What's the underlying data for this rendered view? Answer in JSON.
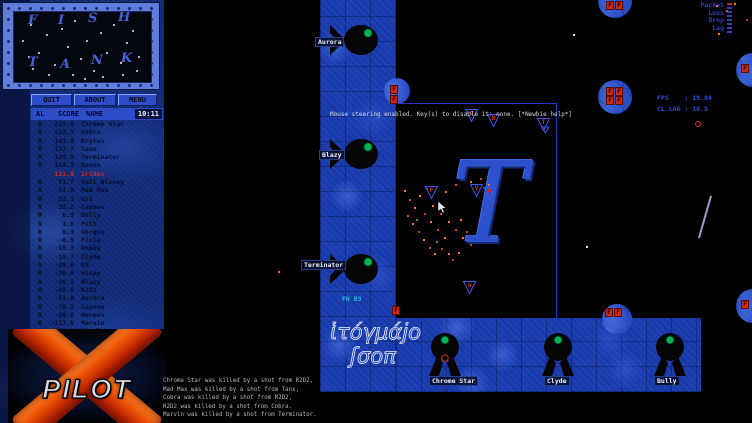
{
  "colors": {
    "wall_blue": "#1c40b4",
    "marble_blue": "#14307e",
    "fuel_red": "#d02810",
    "self_score_red": "#dc2414",
    "hud_blue": "#3648e0",
    "eye_green": "#00b558",
    "logo_orange": "#f05808"
  },
  "minimap": {
    "letters": [
      {
        "ch": "F",
        "x": 14,
        "y": 2
      },
      {
        "ch": "I",
        "x": 44,
        "y": 2
      },
      {
        "ch": "S",
        "x": 74,
        "y": 0
      },
      {
        "ch": "H",
        "x": 104,
        "y": -1
      },
      {
        "ch": "T",
        "x": 14,
        "y": 44
      },
      {
        "ch": "A",
        "x": 46,
        "y": 46
      },
      {
        "ch": "N",
        "x": 77,
        "y": 42
      },
      {
        "ch": "K",
        "x": 107,
        "y": 40
      }
    ],
    "stars": [
      [
        8,
        28
      ],
      [
        16,
        12
      ],
      [
        24,
        40
      ],
      [
        32,
        22
      ],
      [
        40,
        52
      ],
      [
        47,
        16
      ],
      [
        53,
        34
      ],
      [
        60,
        8
      ],
      [
        66,
        46
      ],
      [
        72,
        28
      ],
      [
        79,
        58
      ],
      [
        86,
        20
      ],
      [
        92,
        40
      ],
      [
        99,
        12
      ],
      [
        106,
        50
      ],
      [
        112,
        30
      ],
      [
        118,
        18
      ],
      [
        124,
        44
      ],
      [
        18,
        56
      ],
      [
        34,
        62
      ],
      [
        58,
        62
      ],
      [
        88,
        64
      ],
      [
        108,
        62
      ],
      [
        14,
        44
      ],
      [
        122,
        58
      ],
      [
        70,
        66
      ]
    ]
  },
  "scoreboard": {
    "buttons": [
      "QUIT",
      "ABOUT",
      "MENU"
    ],
    "columns": {
      "al": "AL",
      "score": "SCORE",
      "name": "NAME"
    },
    "time": "10:11",
    "players": [
      {
        "al": "R",
        "score": "229.5",
        "name": "Chrome Star"
      },
      {
        "al": "R",
        "score": "223.7",
        "name": "Cobra"
      },
      {
        "al": "R",
        "score": "143.9",
        "name": "Kryten"
      },
      {
        "al": "R",
        "score": "137.7",
        "name": "Tanx"
      },
      {
        "al": "R",
        "score": "129.5",
        "name": "Terminator"
      },
      {
        "al": "R",
        "score": "124.3",
        "name": "Boson"
      },
      {
        "al": "",
        "score": "121.8",
        "name": "Irides",
        "self": true
      },
      {
        "al": "R",
        "score": "71.7",
        "name": "Dalt Wisney"
      },
      {
        "al": "R",
        "score": "51.9",
        "name": "Mad Max"
      },
      {
        "al": "R",
        "score": "32.3",
        "name": "Uzi"
      },
      {
        "al": "R",
        "score": "32.2",
        "name": "Capone"
      },
      {
        "al": "R",
        "score": "6.9",
        "name": "Bully"
      },
      {
        "al": "R",
        "score": "1.6",
        "name": "Pilt"
      },
      {
        "al": "R",
        "score": "0.3",
        "name": "Gorgon"
      },
      {
        "al": "R",
        "score": "-6.9",
        "name": "Pixie"
      },
      {
        "al": "R",
        "score": "-18.3",
        "name": "Robby"
      },
      {
        "al": "R",
        "score": "-19.7",
        "name": "Clyde"
      },
      {
        "al": "R",
        "score": "-28.6",
        "name": "K9"
      },
      {
        "al": "R",
        "score": "-36.0",
        "name": "Wispy"
      },
      {
        "al": "R",
        "score": "-38.1",
        "name": "Blazy"
      },
      {
        "al": "R",
        "score": "-45.6",
        "name": "R2D2"
      },
      {
        "al": "R",
        "score": "-51.0",
        "name": "Aurora"
      },
      {
        "al": "R",
        "score": "-78.2",
        "name": "Capone"
      },
      {
        "al": "R",
        "score": "-88.8",
        "name": "Hermes"
      },
      {
        "al": "R",
        "score": "-117.5",
        "name": "Marvin"
      },
      {
        "al": "R",
        "score": "-121.8",
        "name": "Metal Hero"
      },
      {
        "al": "R",
        "score": "-157.1",
        "name": "Sniper"
      },
      {
        "al": "R",
        "score": "-211.4",
        "name": "Bonnie"
      }
    ]
  },
  "logo": {
    "text": "PILOT"
  },
  "hud": {
    "message": "Mouse steering enabled. Key(s) to disable it: none. [*Newbie help*]",
    "packet_meter": {
      "labels": [
        "Packet",
        "Loss",
        "Drop",
        "Lag"
      ]
    },
    "fps_line": "FPS    : 19.84",
    "lag_line": "CL.LAG : 10.5",
    "kill_messages": [
      "Chrome Star was killed by a shot from R2D2,",
      "Mad Max was killed by a shot from Tanx,",
      "Cobra was killed by a shot from R2D2,",
      "R2D2 was killed by a shot from Cobra.",
      "Marvin was killed by a shot from Terminator."
    ]
  },
  "map": {
    "big_letter": "T",
    "fuel_letter": "F",
    "decorative_script": [
      "ἱτόγμάϳο",
      "ʃσοπ"
    ],
    "labels": [
      {
        "text": "Aurora",
        "x": 315,
        "y": 37,
        "style": "box"
      },
      {
        "text": "Blazy",
        "x": 319,
        "y": 150,
        "style": "box"
      },
      {
        "text": "Terminator",
        "x": 301,
        "y": 260,
        "style": "box"
      },
      {
        "text": "Chrome Star",
        "x": 429,
        "y": 376,
        "style": "box"
      },
      {
        "text": "Clyde",
        "x": 544,
        "y": 376,
        "style": "box"
      },
      {
        "text": "Bully",
        "x": 654,
        "y": 376,
        "style": "box"
      },
      {
        "text": "FN B3",
        "x": 342,
        "y": 295,
        "style": "plain"
      }
    ],
    "fuel_cells": [
      [
        390,
        85
      ],
      [
        390,
        95
      ],
      [
        392,
        306
      ],
      [
        605,
        308
      ],
      [
        614,
        308
      ],
      [
        606,
        87
      ],
      [
        615,
        87
      ],
      [
        606,
        96
      ],
      [
        615,
        96
      ],
      [
        606,
        1
      ],
      [
        615,
        1
      ],
      [
        741,
        64
      ],
      [
        741,
        300
      ]
    ],
    "ships": [
      {
        "x": 464,
        "y": 108,
        "g": "G"
      },
      {
        "x": 486,
        "y": 113,
        "g": "R"
      },
      {
        "x": 536,
        "y": 117,
        "g": "T"
      },
      {
        "x": 424,
        "y": 185,
        "g": "F"
      },
      {
        "x": 469,
        "y": 183,
        "g": "V"
      },
      {
        "x": 482,
        "y": 186,
        "g": "O"
      },
      {
        "x": 462,
        "y": 280,
        "g": "n"
      }
    ],
    "spark_colors": {
      "o": "#ff7722",
      "d": "#cc4411",
      "g": "#2e9944",
      "w": "#dde4ff"
    },
    "sparks": [
      [
        404,
        190,
        "o"
      ],
      [
        409,
        199,
        "d"
      ],
      [
        414,
        207,
        "o"
      ],
      [
        407,
        215,
        "d"
      ],
      [
        412,
        223,
        "o"
      ],
      [
        418,
        231,
        "d"
      ],
      [
        423,
        239,
        "o"
      ],
      [
        429,
        247,
        "d"
      ],
      [
        434,
        253,
        "o"
      ],
      [
        441,
        248,
        "d"
      ],
      [
        448,
        253,
        "o"
      ],
      [
        452,
        259,
        "d"
      ],
      [
        458,
        252,
        "o"
      ],
      [
        444,
        237,
        "o"
      ],
      [
        437,
        229,
        "d"
      ],
      [
        430,
        221,
        "o"
      ],
      [
        424,
        213,
        "d"
      ],
      [
        432,
        205,
        "o"
      ],
      [
        440,
        213,
        "d"
      ],
      [
        448,
        221,
        "o"
      ],
      [
        455,
        229,
        "d"
      ],
      [
        462,
        237,
        "o"
      ],
      [
        466,
        231,
        "d"
      ],
      [
        460,
        219,
        "o"
      ],
      [
        470,
        244,
        "d"
      ],
      [
        419,
        195,
        "o"
      ],
      [
        426,
        188,
        "d"
      ],
      [
        445,
        191,
        "o"
      ],
      [
        455,
        184,
        "d"
      ],
      [
        470,
        181,
        "o"
      ],
      [
        480,
        178,
        "d"
      ],
      [
        488,
        184,
        "o"
      ],
      [
        416,
        219,
        "g"
      ],
      [
        436,
        241,
        "g"
      ],
      [
        278,
        271,
        "o"
      ],
      [
        716,
        5,
        "o"
      ],
      [
        726,
        10,
        "d"
      ],
      [
        734,
        3,
        "o"
      ],
      [
        746,
        19,
        "d"
      ],
      [
        718,
        33,
        "o"
      ],
      [
        573,
        34,
        "w"
      ],
      [
        586,
        246,
        "w"
      ]
    ]
  }
}
